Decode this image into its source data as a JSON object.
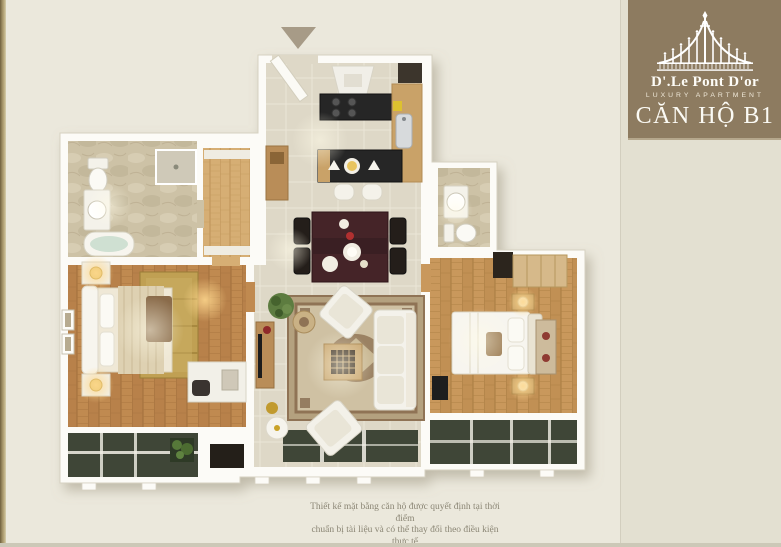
{
  "palette": {
    "page_background": "#ebe8dc",
    "sidebar_background": "#e3e0d1",
    "brand_brown": "#8d7b60",
    "locator_brown": "#6d5d48",
    "text_olive": "#6b6352",
    "wood_floor": "#c08a50",
    "tile_floor": "#dad4c2",
    "glass_dark": "#3f4637"
  },
  "brand": {
    "name": "D'.Le Pont D'or",
    "tagline": "LUXURY APARTMENT"
  },
  "unit": {
    "title": "CĂN HỘ B1"
  },
  "info": {
    "rows": [
      {
        "label": "VỊ TRÍ TẦNG:",
        "value": "TẦNG   3 - 21"
      },
      {
        "label": "LOẠI CĂN HỘ:",
        "value": "2 PHÒNG NGỦ"
      },
      {
        "label": "DIỆN TÍCH CĂN HỘ:",
        "value": "109.6 M2"
      }
    ]
  },
  "rooms": [
    {
      "name": "Sảnh",
      "area": "3.5 m2"
    },
    {
      "name": "Bếp",
      "area": "8.0 m2"
    },
    {
      "name": "Phòng khách + ăn",
      "area": "34.6 m2"
    },
    {
      "name": "Phòng ngủ 1",
      "area": "15.0 m2"
    },
    {
      "name": "Phòng ngủ Master",
      "area": "24.0 m2"
    },
    {
      "name": "WC Master",
      "area": "8.0 m2"
    },
    {
      "name": "WC 1",
      "area": "5.5 m2"
    },
    {
      "name": "Phòng giặt",
      "area": "3.0 m2"
    },
    {
      "name": "Lôgia 1",
      "area": "5.0 m2"
    },
    {
      "name": "Lôgia 2",
      "area": "3.0 m2"
    }
  ],
  "compass": {
    "label": "N"
  },
  "disclaimer": {
    "line1": "Thiết kế mặt bằng căn hộ được quyết định tại thời điểm",
    "line2": "chuẩn bị tài liệu và có thể thay đổi theo điều kiện thực tế"
  }
}
